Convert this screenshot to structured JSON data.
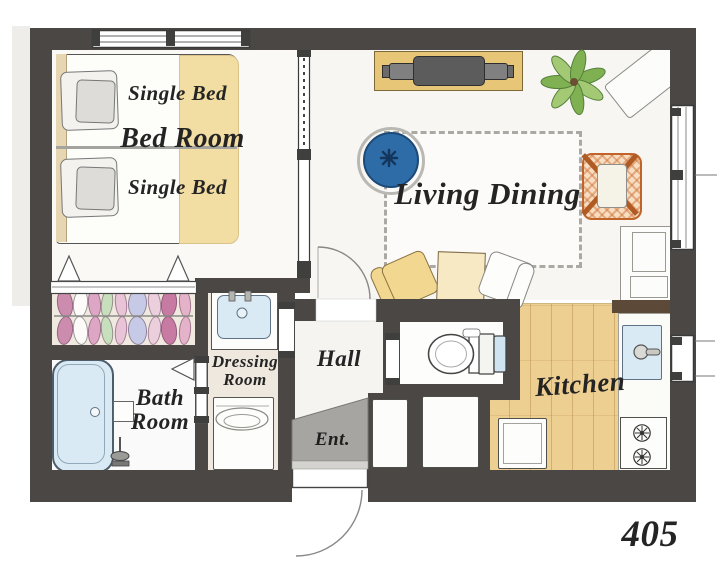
{
  "unit_number": "405",
  "labels": {
    "bedroom": "Bed Room",
    "single_bed_top": "Single Bed",
    "single_bed_bottom": "Single Bed",
    "living_dining": "Living Dining",
    "kitchen": "Kitchen",
    "hall": "Hall",
    "entrance": "Ent.",
    "bath_line1": "Bath",
    "bath_line2": "Room",
    "dressing_line1": "Dressing",
    "dressing_line2": "Room"
  },
  "colors": {
    "wall": "#4b4744",
    "closet_floor": "#efe9df",
    "kitchen_floor": "#eecf92",
    "counter_edge": "#5d4937",
    "water_blue": "#d9eaf4",
    "blanket_yellow": "#f2dda2",
    "headboard_tan": "#e6d6b2",
    "tv_board": "#e7c678",
    "pouf_blue": "#2e6ca8",
    "chair_yellow": "#f1d78f",
    "table_cream": "#f8e9c5",
    "orange_frame": "#c06429",
    "entrance_gray": "#a7a5a2",
    "text": "#242424"
  },
  "closet": {
    "hangers": [
      {
        "x": 64,
        "w": 14,
        "color": "#cb8cad",
        "rot": -7
      },
      {
        "x": 79,
        "w": 13,
        "color": "#fcfbf9",
        "rot": 6,
        "light": true
      },
      {
        "x": 93,
        "w": 11,
        "color": "#dca6c4",
        "rot": -5
      },
      {
        "x": 106,
        "w": 10,
        "color": "#c8dfbe",
        "rot": 7
      },
      {
        "x": 120,
        "w": 10,
        "color": "#e9c3d6",
        "rot": -6
      },
      {
        "x": 136,
        "w": 17,
        "color": "#c7cae6",
        "rot": 4
      },
      {
        "x": 153,
        "w": 11,
        "color": "#eccfdd",
        "rot": -7
      },
      {
        "x": 168,
        "w": 14,
        "color": "#c77ba3",
        "rot": 6
      },
      {
        "x": 184,
        "w": 10,
        "color": "#e4b2c9",
        "rot": -5
      }
    ]
  },
  "fixtures": [
    "twin-single-beds",
    "pillows",
    "closet-hangers",
    "tv-on-board",
    "potted-plant",
    "bench",
    "round-pouf",
    "rug",
    "butterfly-chair",
    "dining-table",
    "dining-chairs",
    "cabinet",
    "bathtub",
    "shower",
    "vanity-sink",
    "washing-machine",
    "toilet",
    "kitchen-sink",
    "gas-stove",
    "fridge",
    "storage-closets",
    "windows",
    "sliding-partition",
    "entry-door"
  ]
}
